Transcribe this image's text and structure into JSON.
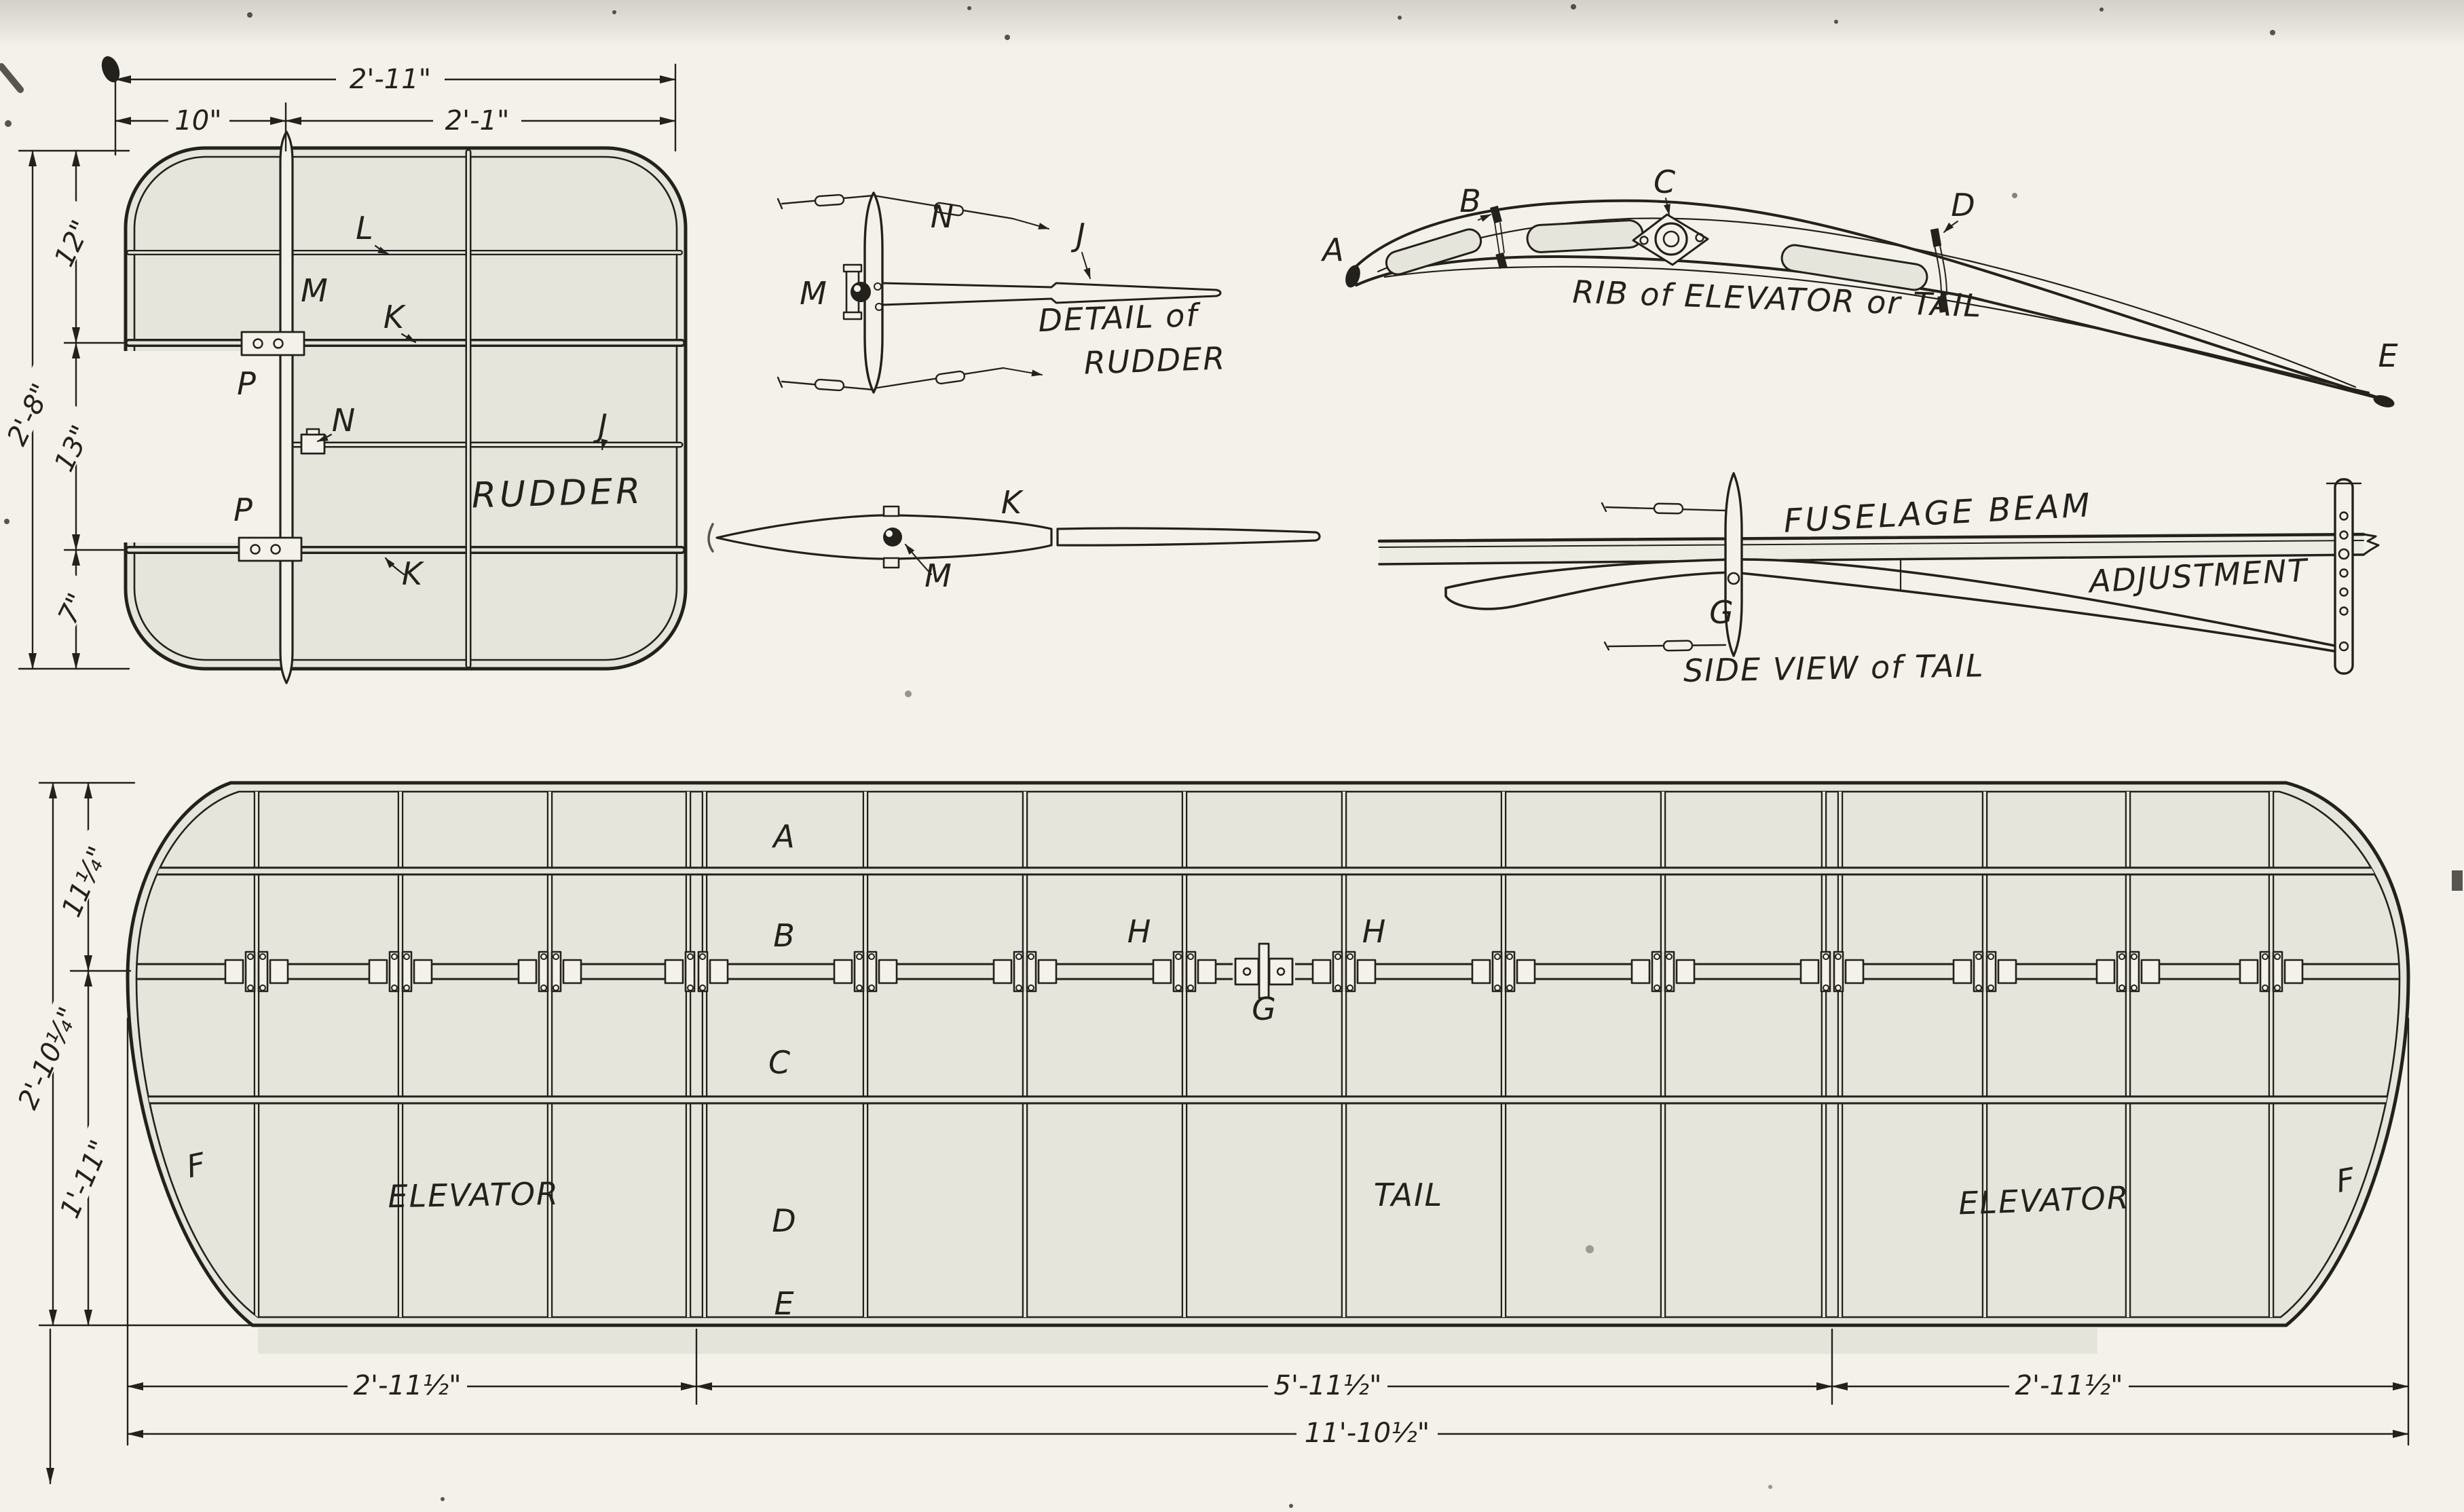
{
  "colors": {
    "paper": "#f3f1e9",
    "panel": "#e5e5dc",
    "ink": "#23211c"
  },
  "drawing": {
    "rudder_plan": {
      "title": "RUDDER",
      "dims": {
        "top_total": "2'-11\"",
        "top_left": "10\"",
        "top_right": "2'-1\"",
        "left_total": "2'-8\"",
        "left_top": "12\"",
        "left_mid": "13\"",
        "left_bottom": "7\""
      },
      "labels": {
        "l": "L",
        "m": "M",
        "k_upper": "K",
        "p_upper": "P",
        "n": "N",
        "j": "J",
        "p_lower": "P",
        "k_lower": "K"
      }
    },
    "rudder_detail": {
      "caption_line1": "DETAIL of",
      "caption_line2": "RUDDER",
      "labels": {
        "n": "N",
        "m": "M",
        "j": "J"
      }
    },
    "spar_detail": {
      "labels": {
        "k": "K",
        "m": "M"
      }
    },
    "rib_detail": {
      "caption": "RIB of ELEVATOR or TAIL",
      "labels": {
        "a": "A",
        "b": "B",
        "c": "C",
        "d": "D",
        "e": "E"
      }
    },
    "tail_side_view": {
      "caption_beam": "FUSELAGE BEAM",
      "caption_adjustment": "ADJUSTMENT",
      "caption_view": "SIDE VIEW of TAIL",
      "labels": {
        "g": "G"
      }
    },
    "main_plan": {
      "stations": {
        "a": "A",
        "b": "B",
        "c": "C",
        "d": "D",
        "e": "E"
      },
      "labels": {
        "h_left": "H",
        "h_right": "H",
        "g": "G",
        "f_left": "F",
        "f_right": "F"
      },
      "panels": {
        "left": "ELEVATOR",
        "center": "TAIL",
        "right": "ELEVATOR"
      },
      "dims": {
        "left_upper": "11¼\"",
        "left_lower": "1'-11\"",
        "left_total": "2'-10¼\"",
        "bottom_left": "2'-11½\"",
        "bottom_center": "5'-11½\"",
        "bottom_right": "2'-11½\"",
        "bottom_total": "11'-10½\""
      }
    }
  }
}
